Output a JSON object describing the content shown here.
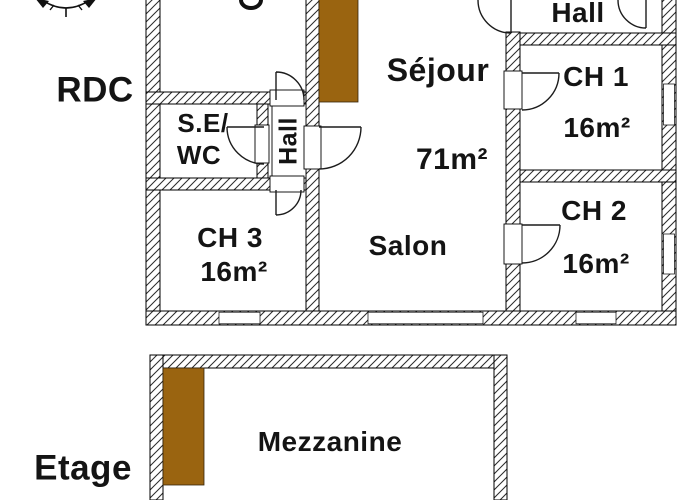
{
  "title": "House floor plan",
  "floors": {
    "rdc": {
      "label": "RDC",
      "rooms": {
        "sejour": {
          "name": "Séjour",
          "area": "71m²"
        },
        "salon": {
          "name": "Salon"
        },
        "hall_top": {
          "name": "Hall"
        },
        "hall_corridor": {
          "name": "Hall"
        },
        "se_wc": {
          "line1": "S.E/",
          "line2": "WC"
        },
        "ch1": {
          "name": "CH 1",
          "area": "16m²"
        },
        "ch2": {
          "name": "CH 2",
          "area": "16m²"
        },
        "ch3": {
          "name": "CH 3",
          "area": "16m²"
        }
      }
    },
    "etage": {
      "label": "Etage",
      "rooms": {
        "mezzanine": {
          "name": "Mezzanine"
        }
      }
    }
  },
  "icons": {
    "compass": "compass-icon"
  },
  "colors": {
    "stairs_brown": "#9A6410",
    "wall_line": "#000000",
    "text": "#141414",
    "background": "#ffffff"
  }
}
